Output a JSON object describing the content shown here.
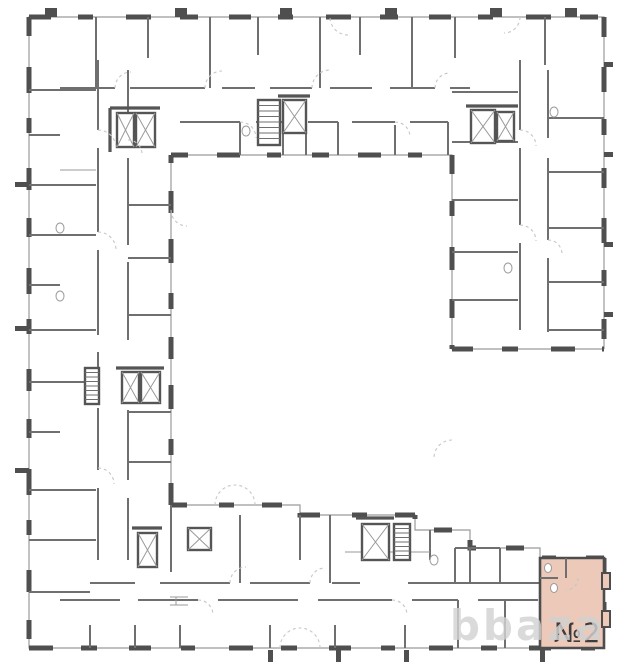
{
  "floorplan": {
    "highlighted_unit": {
      "label": "№2"
    },
    "watermark": {
      "text": "bbaza"
    },
    "colors": {
      "background": "#ffffff",
      "exterior_pier": "#4f4f4f",
      "window_line": "#9a9a9a",
      "interior_wall": "#6f6f6f",
      "thick_wall": "#555555",
      "door_arc": "#c6c6c6",
      "unit_fill": "#ecc9b9",
      "unit_border": "#4d4d4d",
      "unit_label": "#3d3d3d",
      "watermark_color": "#d2d2d2"
    }
  }
}
